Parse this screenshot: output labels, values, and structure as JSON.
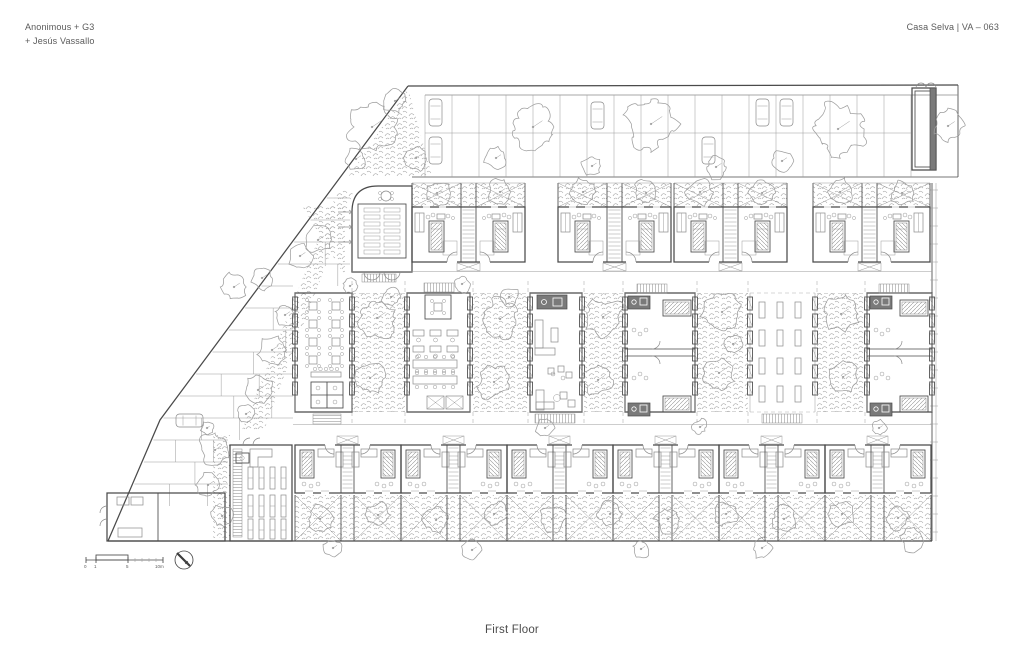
{
  "header": {
    "architect_line1": "Anonimous + G3",
    "architect_line2": "+ Jesús Vassallo",
    "project_ref": "Casa Selva | VA – 063"
  },
  "caption": "First Floor",
  "scale_bar": {
    "tick_labels": [
      "0",
      "1",
      "5",
      "10m"
    ]
  },
  "icons": {
    "north_arrow": "north-arrow-icon",
    "scale": "scale-bar-icon"
  },
  "colors": {
    "paper": "#ffffff",
    "ink": "#4a4a4a",
    "thin_line": "#8a8a8a",
    "vegetation": "#9e9e9e",
    "text": "#5a5a5a"
  }
}
